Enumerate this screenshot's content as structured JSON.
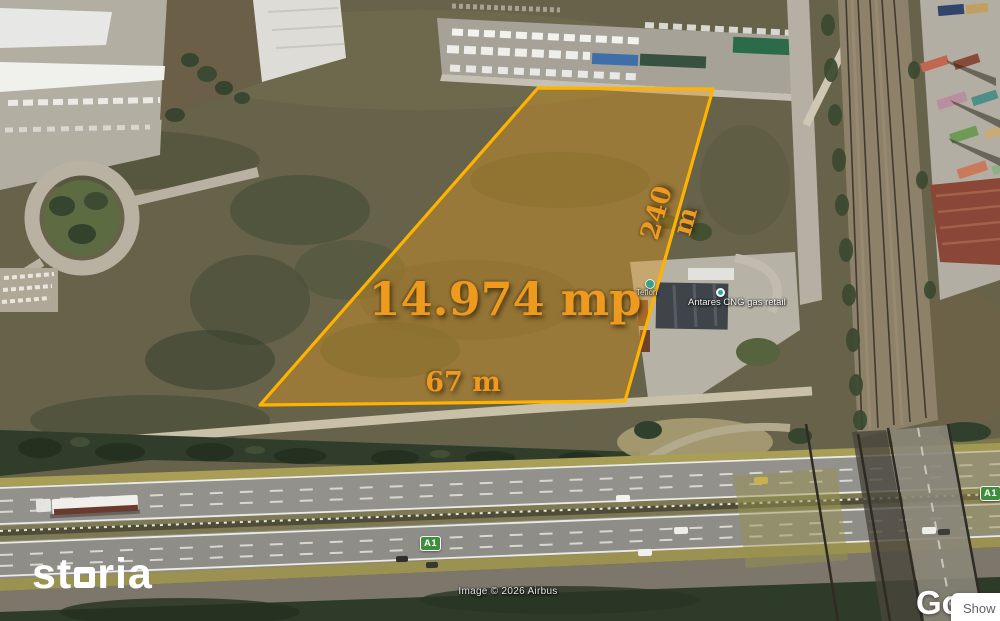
{
  "plot_overlay": {
    "area_label": "14.974 mp",
    "depth_label": "240 m",
    "frontage_label": "67 m",
    "outline_color": "#FFB300",
    "label_color": "#ED9A1F"
  },
  "map_pois": {
    "poi_label_small": "Teflon",
    "gas_station_label": "Antares CNG gas retail",
    "marker_color": "#2AA8A0"
  },
  "road_badges": {
    "a1_center": "A1",
    "a1_right": "A1",
    "badge_color": "#3D8F3D"
  },
  "watermark": {
    "brand_prefix": "st",
    "brand_suffix": "ria",
    "brand_color": "#FFFFFF"
  },
  "attribution": {
    "imagery_credit": "Image © 2026 Airbus",
    "google_logo_partial": "Go",
    "tooltip_label": "Show"
  }
}
